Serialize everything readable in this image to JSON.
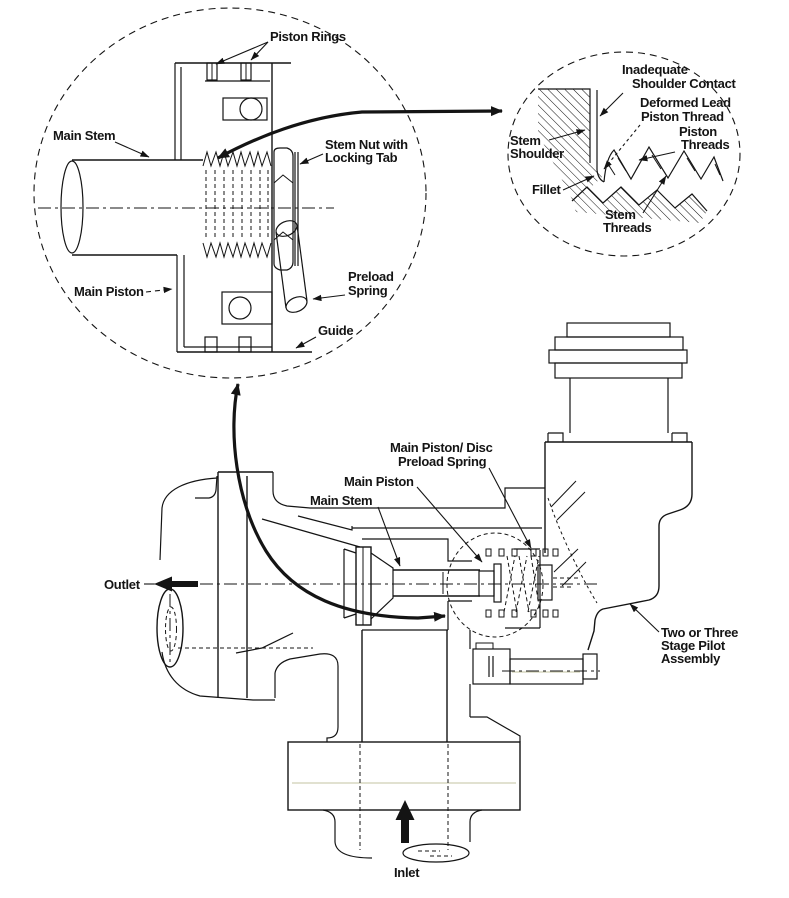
{
  "figure": {
    "colors": {
      "background": "#ffffff",
      "ink": "#141414"
    },
    "detail_left": {
      "labels": {
        "piston_rings": "Piston Rings",
        "main_stem": "Main Stem",
        "stem_nut_1": "Stem Nut with",
        "stem_nut_2": "Locking Tab",
        "main_piston": "Main Piston",
        "preload_1": "Preload",
        "preload_2": "Spring",
        "guide": "Guide"
      }
    },
    "detail_right": {
      "labels": {
        "inadequate_1": "Inadequate",
        "inadequate_2": "Shoulder Contact",
        "deformed_1": "Deformed Lead",
        "deformed_2": "Piston Thread",
        "piston_1": "Piston",
        "piston_2": "Threads",
        "shoulder_1": "Stem",
        "shoulder_2": "Shoulder",
        "fillet": "Fillet",
        "stem_threads_1": "Stem",
        "stem_threads_2": "Threads"
      }
    },
    "assembly": {
      "labels": {
        "mp_disc_1": "Main Piston/ Disc",
        "mp_disc_2": "Preload Spring",
        "main_piston": "Main Piston",
        "main_stem": "Main Stem",
        "outlet": "Outlet",
        "inlet": "Inlet",
        "pilot_1": "Two or Three",
        "pilot_2": "Stage Pilot",
        "pilot_3": "Assembly"
      }
    }
  }
}
